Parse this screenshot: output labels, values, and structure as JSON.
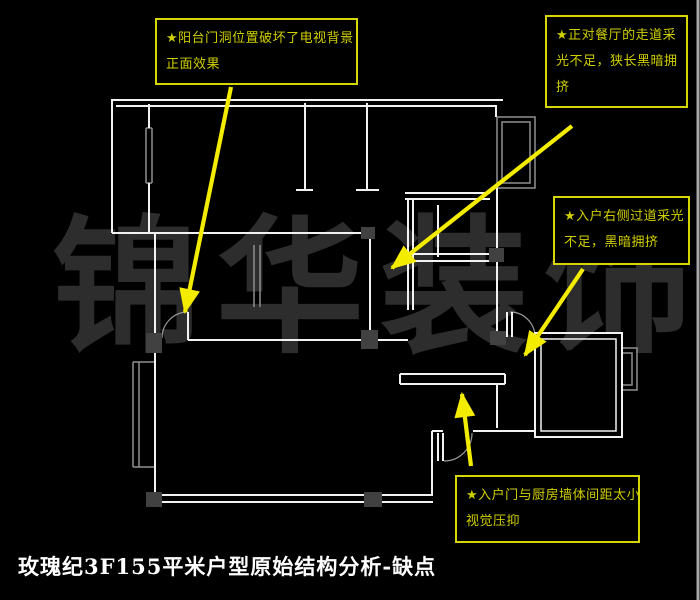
{
  "title": "玫瑰纪3F155平米户型原始结构分析-缺点",
  "watermark": {
    "text": "锦华装饰"
  },
  "annotations": [
    {
      "name": "balcony-door-issue",
      "line1": "★阳台门洞位置破坏了电视背景",
      "line2": "正面效果"
    },
    {
      "name": "dining-corridor-issue",
      "line1": "★正对餐厅的走道采",
      "line2": "光不足，狭长黑暗拥",
      "line3": "挤"
    },
    {
      "name": "entry-right-passage-issue",
      "line1": "★入户右侧过道采光",
      "line2": "不足，黑暗拥挤"
    },
    {
      "name": "entry-kitchen-gap-issue",
      "line1": "★入户门与厨房墙体间距太小",
      "line2": "视觉压抑"
    }
  ],
  "colors": {
    "background": "#000000",
    "wall": "#f2f2f2",
    "secondary": "#8f8f8f",
    "annotation_border": "#d6d600",
    "annotation_text": "#cfcf00",
    "arrow": "#f3eb00",
    "watermark": "#2d2d2d",
    "title": "#ffffff"
  }
}
